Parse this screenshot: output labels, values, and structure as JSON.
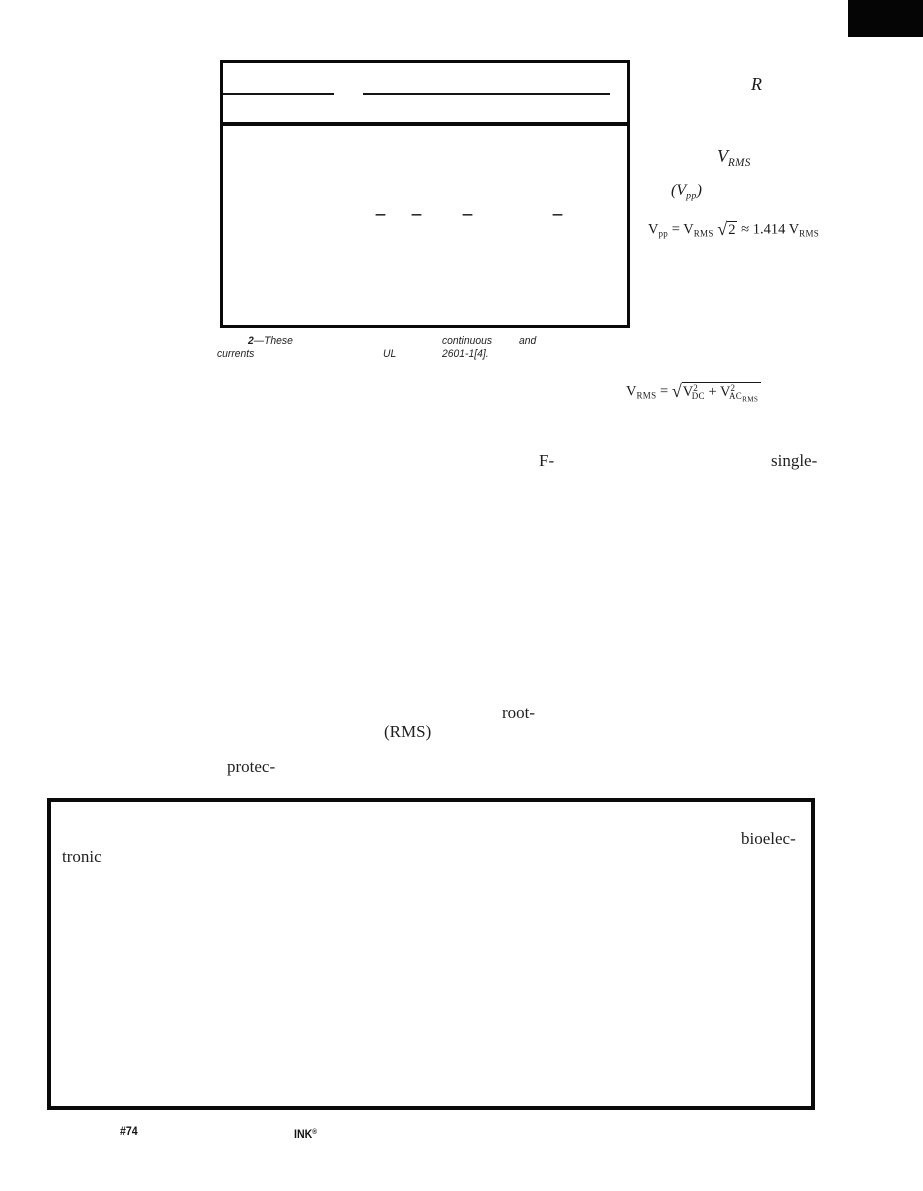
{
  "table": {
    "cells": {
      "dash1": "—",
      "dash2": "—",
      "dash3": "—",
      "dash4": "—"
    },
    "caption": {
      "number": "2",
      "line1_a": "—These",
      "line1_b": "continuous",
      "line1_c": "and",
      "line2_a": "currents",
      "line2_b": "UL",
      "line2_c": "2601-1[4]."
    }
  },
  "margin_notes": {
    "r_symbol": "R",
    "vrms_base": "V",
    "vrms_sub": "RMS",
    "vpp_open": "(",
    "vpp_base": "V",
    "vpp_sub": "pp",
    "vpp_close": ")"
  },
  "equations": {
    "vpp": {
      "lhs_base": "V",
      "lhs_sub": "pp",
      "eq": "=",
      "a_base": "V",
      "a_sub": "RMS",
      "root_sign": "√",
      "root_val": "2",
      "approx": "≈",
      "coef": "1.414",
      "b_base": "V",
      "b_sub": "RMS"
    },
    "vrms": {
      "lhs_base": "V",
      "lhs_sub": "RMS",
      "eq": "=",
      "root_sign": "√",
      "t1_base": "V",
      "t1_sup": "2",
      "t1_sub": "DC",
      "plus": "+",
      "t2_base": "V",
      "t2_sup": "2",
      "t2_sub": "AC",
      "t2_subsub": "RMS"
    }
  },
  "body_fragments": {
    "f_word": "F-",
    "single_word": "single-",
    "root_word": "root-",
    "rms_word": "(RMS)",
    "protec_word": "protec-",
    "bioelec_word": "bioelec-",
    "tronic_word": "tronic"
  },
  "footer": {
    "issue": "#74",
    "magazine": "INK",
    "reg": "®"
  }
}
